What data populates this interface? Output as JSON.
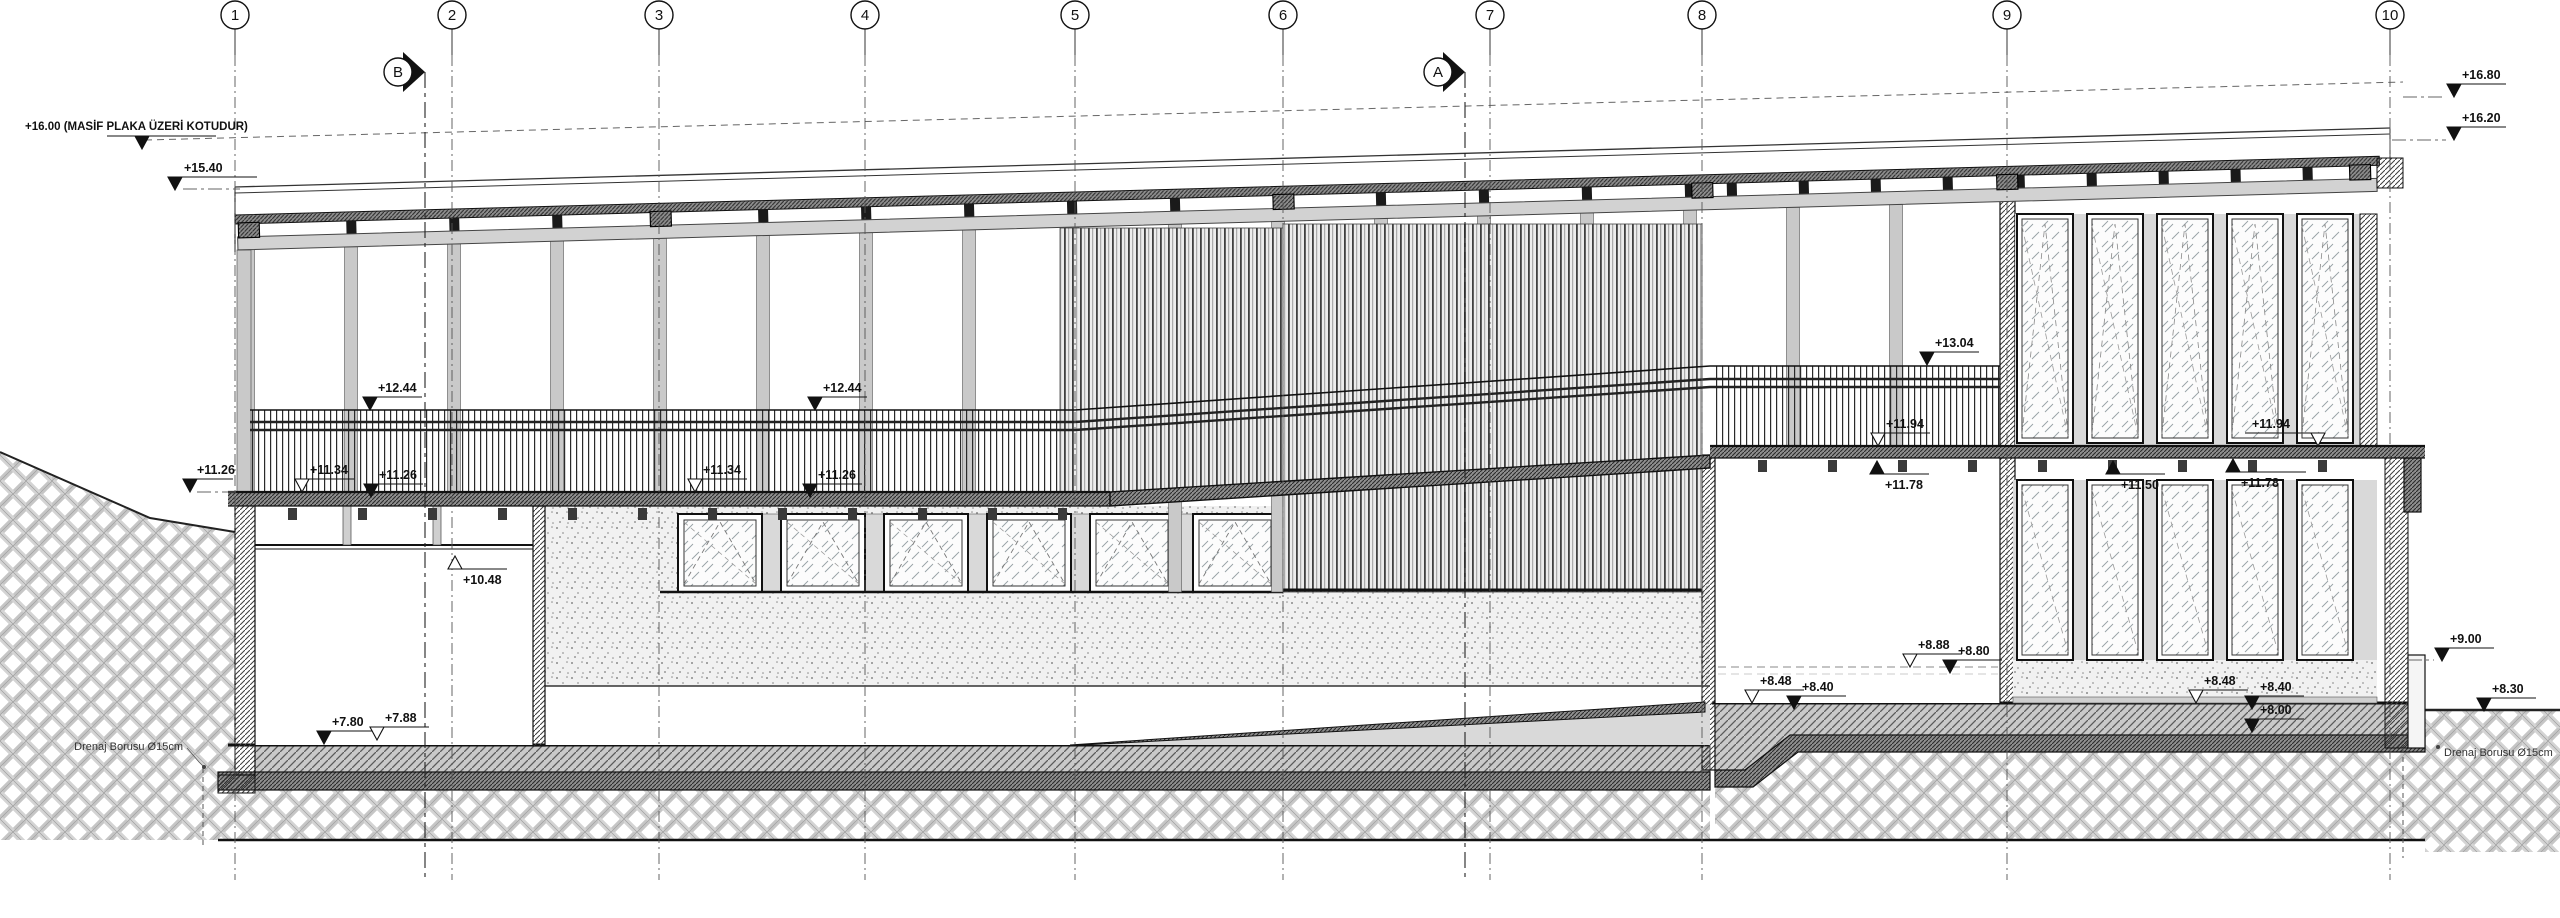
{
  "drawing": {
    "type": "building-section-elevation",
    "note_1600": "+16.00 (MASİF PLAKA ÜZERİ KOTUDUR)"
  },
  "grid_bubbles": [
    {
      "label": "1",
      "x": 235
    },
    {
      "label": "2",
      "x": 452
    },
    {
      "label": "3",
      "x": 659
    },
    {
      "label": "4",
      "x": 865
    },
    {
      "label": "5",
      "x": 1075
    },
    {
      "label": "6",
      "x": 1283
    },
    {
      "label": "7",
      "x": 1490
    },
    {
      "label": "8",
      "x": 1702
    },
    {
      "label": "9",
      "x": 2007
    },
    {
      "label": "10",
      "x": 2390
    }
  ],
  "section_markers": [
    {
      "label": "B",
      "x": 425
    },
    {
      "label": "A",
      "x": 1465
    }
  ],
  "elevation_markers": [
    {
      "label": "+16.00 (MASİF PLAKA ÜZERİ KOTUDUR)",
      "x": 142,
      "y": 149,
      "dir": "down",
      "open": false,
      "tx": 25,
      "ty": 130,
      "ul": [
        107,
        216
      ],
      "note": true
    },
    {
      "label": "+15.40",
      "x": 175,
      "y": 190,
      "dir": "down",
      "open": false,
      "tx": 184,
      "ul": [
        168,
        257
      ]
    },
    {
      "label": "+11.26",
      "x": 190,
      "y": 492,
      "dir": "down",
      "open": false,
      "tx": 197,
      "ul": [
        183,
        233
      ]
    },
    {
      "label": "+11.34",
      "x": 302,
      "y": 492,
      "dir": "down",
      "open": true
    },
    {
      "label": "+11.26",
      "x": 371,
      "y": 497,
      "dir": "down",
      "open": false
    },
    {
      "label": "+12.44",
      "x": 370,
      "y": 410,
      "dir": "down",
      "open": false
    },
    {
      "label": "+11.34",
      "x": 695,
      "y": 492,
      "dir": "down",
      "open": true
    },
    {
      "label": "+11.26",
      "x": 810,
      "y": 497,
      "dir": "down",
      "open": false
    },
    {
      "label": "+12.44",
      "x": 815,
      "y": 410,
      "dir": "down",
      "open": false
    },
    {
      "label": "+10.48",
      "x": 455,
      "y": 556,
      "dir": "up",
      "open": true
    },
    {
      "label": "+7.80",
      "x": 324,
      "y": 744,
      "dir": "down",
      "open": false
    },
    {
      "label": "+7.88",
      "x": 377,
      "y": 740,
      "dir": "down",
      "open": true
    },
    {
      "label": "+13.04",
      "x": 1927,
      "y": 365,
      "dir": "down",
      "open": false
    },
    {
      "label": "+11.94",
      "x": 1878,
      "y": 446,
      "dir": "down",
      "open": true
    },
    {
      "label": "+11.78",
      "x": 1877,
      "y": 461,
      "dir": "up",
      "open": false
    },
    {
      "label": "+11.50",
      "x": 2113,
      "y": 461,
      "dir": "up",
      "open": false
    },
    {
      "label": "+11.94",
      "x": 2318,
      "y": 446,
      "dir": "down",
      "open": true,
      "tx": 2252,
      "ul": [
        2245,
        2325
      ]
    },
    {
      "label": "+11.78",
      "x": 2233,
      "y": 459,
      "dir": "up",
      "open": false,
      "tx": 2241,
      "ul": [
        2226,
        2306
      ]
    },
    {
      "label": "+8.48",
      "x": 1752,
      "y": 703,
      "dir": "down",
      "open": true
    },
    {
      "label": "+8.40",
      "x": 1794,
      "y": 709,
      "dir": "down",
      "open": false
    },
    {
      "label": "+8.88",
      "x": 1910,
      "y": 667,
      "dir": "down",
      "open": true
    },
    {
      "label": "+8.80",
      "x": 1950,
      "y": 673,
      "dir": "down",
      "open": false
    },
    {
      "label": "+8.48",
      "x": 2196,
      "y": 703,
      "dir": "down",
      "open": true
    },
    {
      "label": "+8.40",
      "x": 2252,
      "y": 709,
      "dir": "down",
      "open": false
    },
    {
      "label": "+8.00",
      "x": 2252,
      "y": 732,
      "dir": "down",
      "open": false
    },
    {
      "label": "+9.00",
      "x": 2442,
      "y": 661,
      "dir": "down",
      "open": false
    },
    {
      "label": "+8.30",
      "x": 2484,
      "y": 711,
      "dir": "down",
      "open": false
    },
    {
      "label": "+16.80",
      "x": 2454,
      "y": 97,
      "dir": "down",
      "open": false
    },
    {
      "label": "+16.20",
      "x": 2454,
      "y": 140,
      "dir": "down",
      "open": false
    }
  ],
  "drain_labels": {
    "left": "Drenaj Borusu Ø15cm",
    "right": "Drenaj Borusu Ø15cm"
  }
}
